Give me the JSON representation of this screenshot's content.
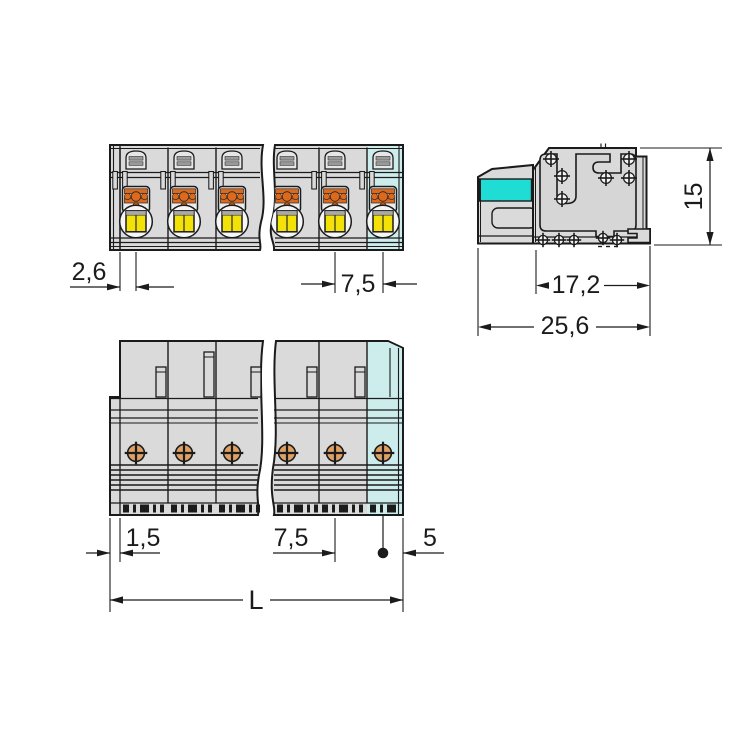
{
  "drawing_type": "connector-dimension-drawing",
  "dimensions": {
    "front_edge_offset": "2,6",
    "front_pitch": "7,5",
    "side_height": "15",
    "side_body_depth": "17,2",
    "side_total_depth": "25,6",
    "top_edge_offset": "1,5",
    "top_pitch": "7,5",
    "top_end_offset": "5",
    "top_total_length": "L"
  },
  "colors": {
    "line": "#1b1b1b",
    "body": "#dadada",
    "body_light": "#ececec",
    "arch_fill": "#e6e6e6",
    "circle_fill": "#f6f6f6",
    "cyan_bright": "#1fdcd4",
    "cyan_pale": "#cdecec",
    "orange": "#dd6a1c",
    "marker_orange": "#dfa066",
    "yellow": "#f2e208",
    "bar_gray": "#9a9a9a",
    "strip_gray": "#a9a9a9"
  }
}
